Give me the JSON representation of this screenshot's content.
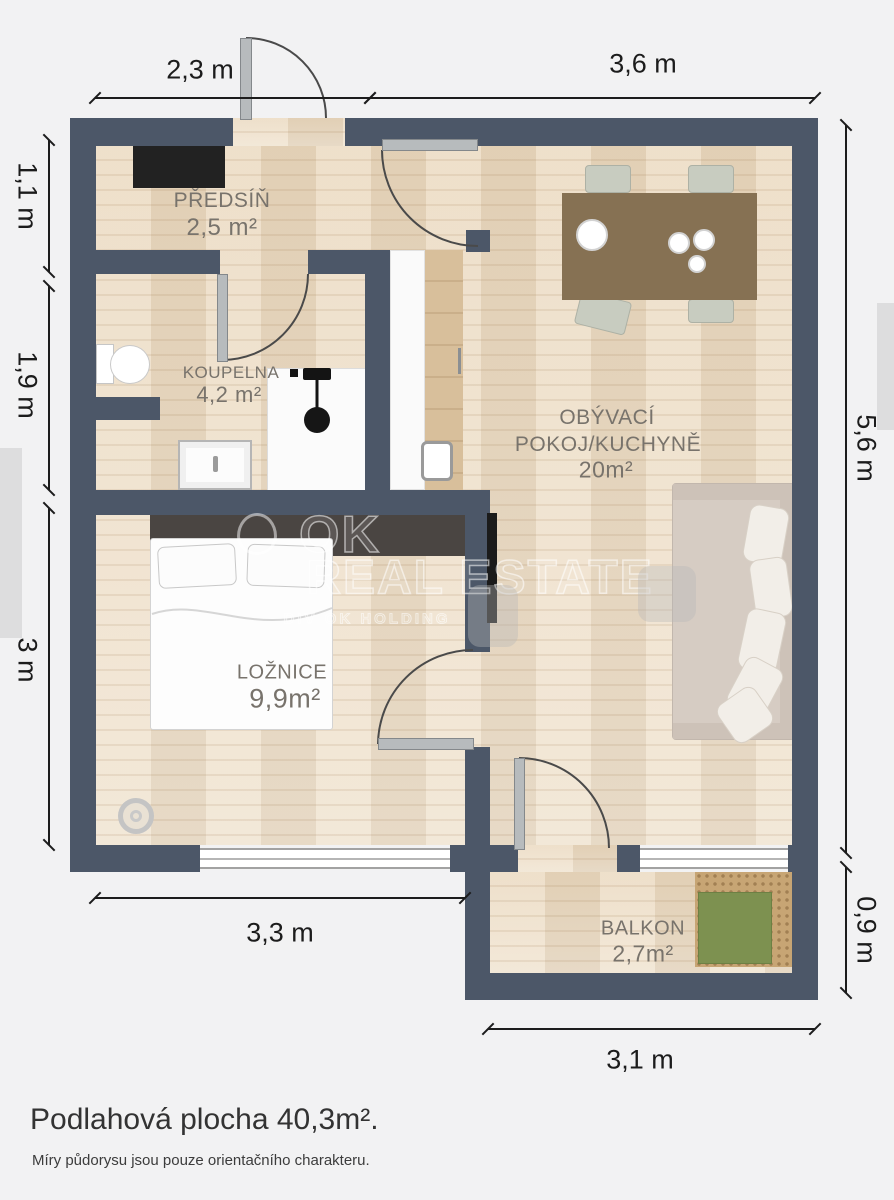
{
  "colors": {
    "wall": "#4c5768",
    "floor": "#ebdcc5",
    "dim": "#1c1c1c",
    "label": "#78736c",
    "bg": "#f2f2f3"
  },
  "rooms": {
    "hallway": {
      "name": "PŘEDSÍŇ",
      "area": "2,5 m²"
    },
    "bathroom": {
      "name": "KOUPELNA",
      "area": "4,2 m²"
    },
    "living": {
      "name_line1": "OBÝVACÍ",
      "name_line2": "POKOJ/KUCHYNĚ",
      "area": "20m²"
    },
    "bedroom": {
      "name": "LOŽNICE",
      "area": "9,9m²"
    },
    "balcony": {
      "name": "BALKON",
      "area": "2,7m²"
    }
  },
  "dimensions": {
    "top_left": "2,3 m",
    "top_right": "3,6 m",
    "left_top": "1,1 m",
    "left_middle": "1,9 m",
    "left_bottom": "3 m",
    "right_top": "5,6 m",
    "right_bottom": "0,9 m",
    "bottom_left": "3,3 m",
    "bottom_right": "3,1 m"
  },
  "watermark": {
    "brand_line1": "OK",
    "brand_line2": "REAL ESTATE",
    "brand_line3": "DIV OK HOLDING"
  },
  "footer": {
    "total_area": "Podlahová plocha 40,3m².",
    "disclaimer": "Míry půdorysu jsou pouze orientačního charakteru."
  }
}
